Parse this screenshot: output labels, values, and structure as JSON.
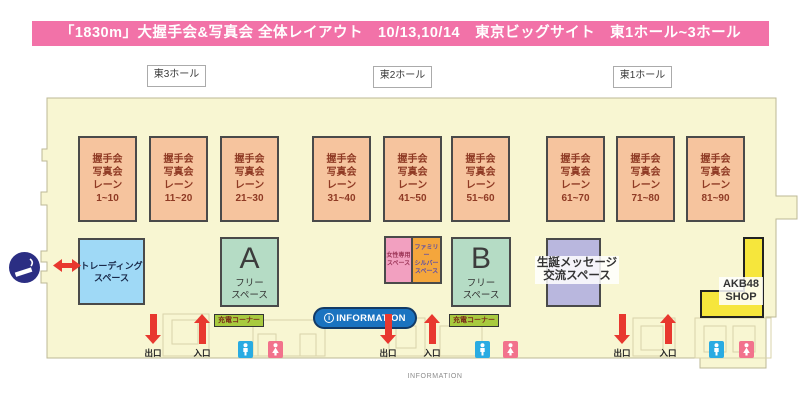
{
  "title_bar": {
    "text": "「1830m」大握手会&写真会 全体レイアウト　10/13,10/14　東京ビッグサイト　東1ホール~3ホール"
  },
  "halls": [
    "東3ホール",
    "東2ホール",
    "東1ホール"
  ],
  "lane_block_lines": [
    "握手会",
    "写真会",
    "レーン"
  ],
  "lane_ranges": [
    "1~10",
    "11~20",
    "21~30",
    "31~40",
    "41~50",
    "51~60",
    "61~70",
    "71~80",
    "81~90"
  ],
  "areas": {
    "trading": {
      "line1": "トレーディング",
      "line2": "スペース"
    },
    "free_a": {
      "letter": "A",
      "line1": "フリー",
      "line2": "スペース"
    },
    "free_b": {
      "letter": "B",
      "line1": "フリー",
      "line2": "スペース"
    },
    "women": {
      "line1": "女性専用",
      "line2": "スペース"
    },
    "family": {
      "line1": "ファミリー",
      "line2": "シルバー",
      "line3": "スペース"
    },
    "birthday": {
      "line1": "生誕メッセージ",
      "line2": "交流スペース"
    },
    "shop": {
      "line1": "AKB48",
      "line2": "SHOP"
    }
  },
  "labels": {
    "charge": "充電コーナー",
    "exit": "出口",
    "entrance": "入口",
    "info_icon": "i",
    "info_badge": "INFORMATION",
    "info_bottom": "INFORMATION"
  },
  "colors": {
    "title_pink": "#F272A8",
    "building": "#F8F6D2",
    "lane_orange": "#F6C49E",
    "lane_text": "#8F3A24",
    "trading_blue": "#9FD9F6",
    "free_green": "#B5DCC5",
    "women_pink": "#F2A0C0",
    "family_orange": "#F4A63C",
    "birthday_purple": "#B9B7DE",
    "shop_yellow": "#F6E63C",
    "charge_green": "#A8CA3F",
    "info_blue": "#1A73C0",
    "arrow_red": "#E8382F",
    "wc_male": "#29ABE2",
    "wc_female": "#F2728C",
    "smoking_navy": "#2B2E83"
  }
}
